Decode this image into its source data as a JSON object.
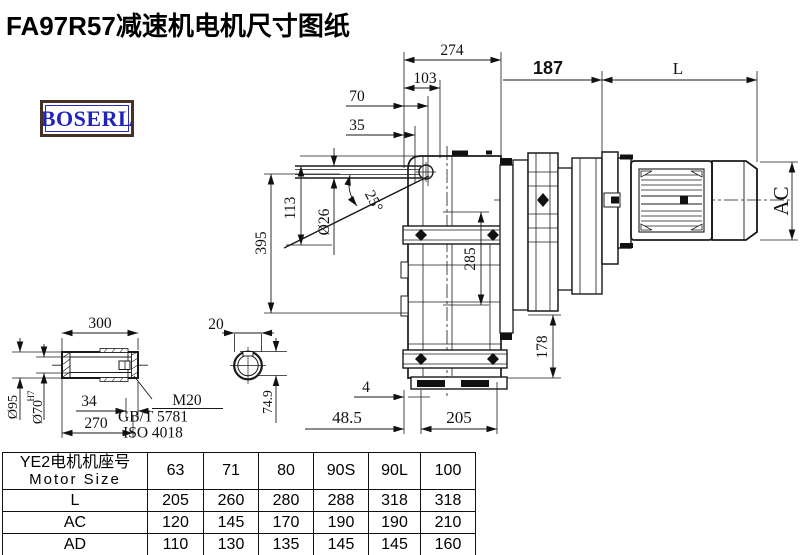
{
  "title": "FA97R57减速机电机尺寸图纸",
  "logo": {
    "text": "BOSERL"
  },
  "drawing": {
    "dims": {
      "d274": "274",
      "d103": "103",
      "d70": "70",
      "d35": "35",
      "d187": "187",
      "dL": "L",
      "d395": "395",
      "d113": "113",
      "dphi26": "Ø26",
      "dangle25": "25°",
      "d285": "285",
      "d178": "178",
      "dAC": "AC",
      "d4": "4",
      "d485": "48.5",
      "d205": "205",
      "d300": "300",
      "d20": "20",
      "d749": "74.9",
      "dphi95": "Ø95",
      "dphi70": "Ø70",
      "dphi70sup": "H7",
      "d34": "34",
      "d270": "270",
      "m20": "M20",
      "gbt": "GB/T 5781",
      "iso": "ISO 4018"
    }
  },
  "table": {
    "header_cn": "YE2电机机座号",
    "header_en": "Motor Size",
    "sizes": [
      "63",
      "71",
      "80",
      "90S",
      "90L",
      "100"
    ],
    "rows": [
      {
        "label": "L",
        "values": [
          "205",
          "260",
          "280",
          "288",
          "318",
          "318"
        ]
      },
      {
        "label": "AC",
        "values": [
          "120",
          "145",
          "170",
          "190",
          "190",
          "210"
        ]
      },
      {
        "label": "AD",
        "values": [
          "110",
          "130",
          "135",
          "145",
          "145",
          "160"
        ]
      }
    ]
  }
}
